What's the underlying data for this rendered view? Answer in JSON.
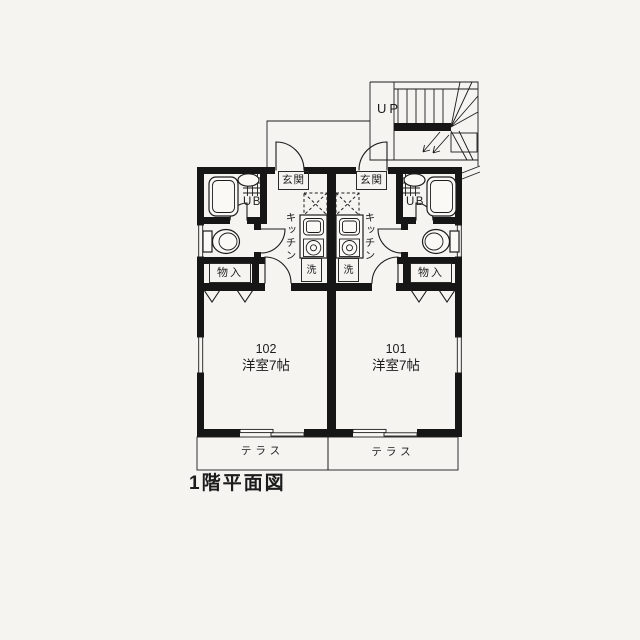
{
  "colors": {
    "paper": "#f5f4f1",
    "ink": "#1c1c1c"
  },
  "caption": "1階平面図",
  "stairs": {
    "direction_label": "UP"
  },
  "labels": {
    "entrance": "玄関",
    "unit_bath": "UB",
    "kitchen": "キッチン",
    "washer": "洗",
    "storage": "物入",
    "terrace": "テラス"
  },
  "units": [
    {
      "number": "102",
      "room_type": "洋室7帖"
    },
    {
      "number": "101",
      "room_type": "洋室7帖"
    }
  ]
}
